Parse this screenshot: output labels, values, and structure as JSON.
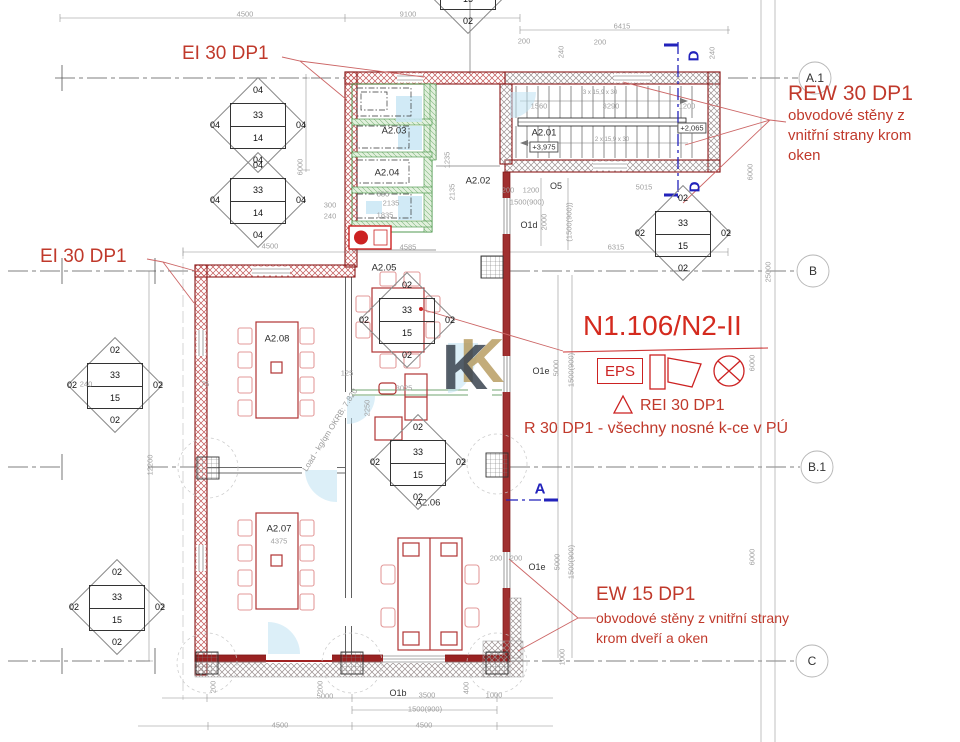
{
  "fire_labels": {
    "ei30_top": "EI 30 DP1",
    "ei30_left": "EI 30 DP1",
    "rew30_title": "REW 30 DP1",
    "rew30_line1": "obvodové stěny z",
    "rew30_line2": "vnitřní strany krom",
    "rew30_line3": "oken",
    "zone": "N1.106/N2-II",
    "eps": "EPS",
    "rei30": "REI 30 DP1",
    "r30": "R 30 DP1 - všechny nosné k-ce v PÚ",
    "ew15_title": "EW 15 DP1",
    "ew15_line1": "obvodové stěny z vnitřní strany",
    "ew15_line2": "krom dveří a oken"
  },
  "grid_labels": {
    "a1": "A.1",
    "b": "B",
    "b1": "B.1",
    "c": "C"
  },
  "section_markers": {
    "d": "D",
    "a": "A"
  },
  "rooms": {
    "a201": "A2.01",
    "a202": "A2.02",
    "a203": "A2.03",
    "a204": "A2.04",
    "a205": "A2.05",
    "a206": "A2.06",
    "a207": "A2.07",
    "a208": "A2.08"
  },
  "levels": {
    "a201": "+3,975",
    "stair": "+2,065",
    "a207_dim": "4375"
  },
  "openings": {
    "o5": "O5",
    "o1d": "O1d",
    "o1e_a": "O1e",
    "o1e_b": "O1e",
    "o1b": "O1b"
  },
  "load_note": "Load - kg/qm OKRB: 7.820",
  "stair_note_top": "3 x 15,9 x 30",
  "stair_note_bottom": "2 x 15,9 x 30",
  "watermark": {
    "k1": "K",
    "k2": "K"
  },
  "diamonds": [
    {
      "t": "04",
      "u": "33",
      "l": "14",
      "b": "04",
      "lf": "04",
      "rg": "04"
    },
    {
      "t": "04",
      "u": "33",
      "l": "14",
      "b": "04",
      "lf": "04",
      "rg": "04"
    },
    {
      "t": "02",
      "u": "33",
      "l": "15",
      "b": "02",
      "lf": "02",
      "rg": "02"
    },
    {
      "t": "02",
      "u": "33",
      "l": "15",
      "b": "02",
      "lf": "02",
      "rg": "02"
    },
    {
      "t": "02",
      "u": "33",
      "l": "15",
      "b": "02",
      "lf": "02",
      "rg": "02"
    },
    {
      "t": "02",
      "u": "33",
      "l": "15",
      "b": "02",
      "lf": "02",
      "rg": "02"
    },
    {
      "t": "02",
      "u": "33",
      "l": "15",
      "b": "02",
      "lf": "02",
      "rg": "02"
    },
    {
      "t": "02",
      "u": "33",
      "l": "15",
      "b": "02",
      "lf": "02",
      "rg": "02"
    }
  ],
  "dims": [
    "4500",
    "9100",
    "6415",
    "200",
    "240",
    "1560",
    "3290",
    "1200",
    "5015",
    "200",
    "1200",
    "1500(900)",
    "2000",
    "(1500(900))",
    "6315",
    "4500",
    "6000",
    "240",
    "75",
    "12200",
    "3025",
    "2250",
    "125",
    "885",
    "2135",
    "1835",
    "4585",
    "5000",
    "1500(900)",
    "6000",
    "25000",
    "6000",
    "5000",
    "3500",
    "1000",
    "1500(900)",
    "4500",
    "4500",
    "5000",
    "1500(900)",
    "6000",
    "1000",
    "200",
    "200",
    "400",
    "200",
    "200",
    "240",
    "200",
    "2135",
    "1235",
    "300",
    "240"
  ],
  "colors": {
    "annotation_red": "#c0392b",
    "zone_red": "#d42a1e",
    "wall_red": "#8b1a1a",
    "section_blue": "#2222bb",
    "wc_green": "#3f8f3f",
    "logo_gold": "#b5985a",
    "logo_slate": "#3a4450",
    "door_blue": "#bfe2f2",
    "dim_gray": "#a0a0a0"
  }
}
